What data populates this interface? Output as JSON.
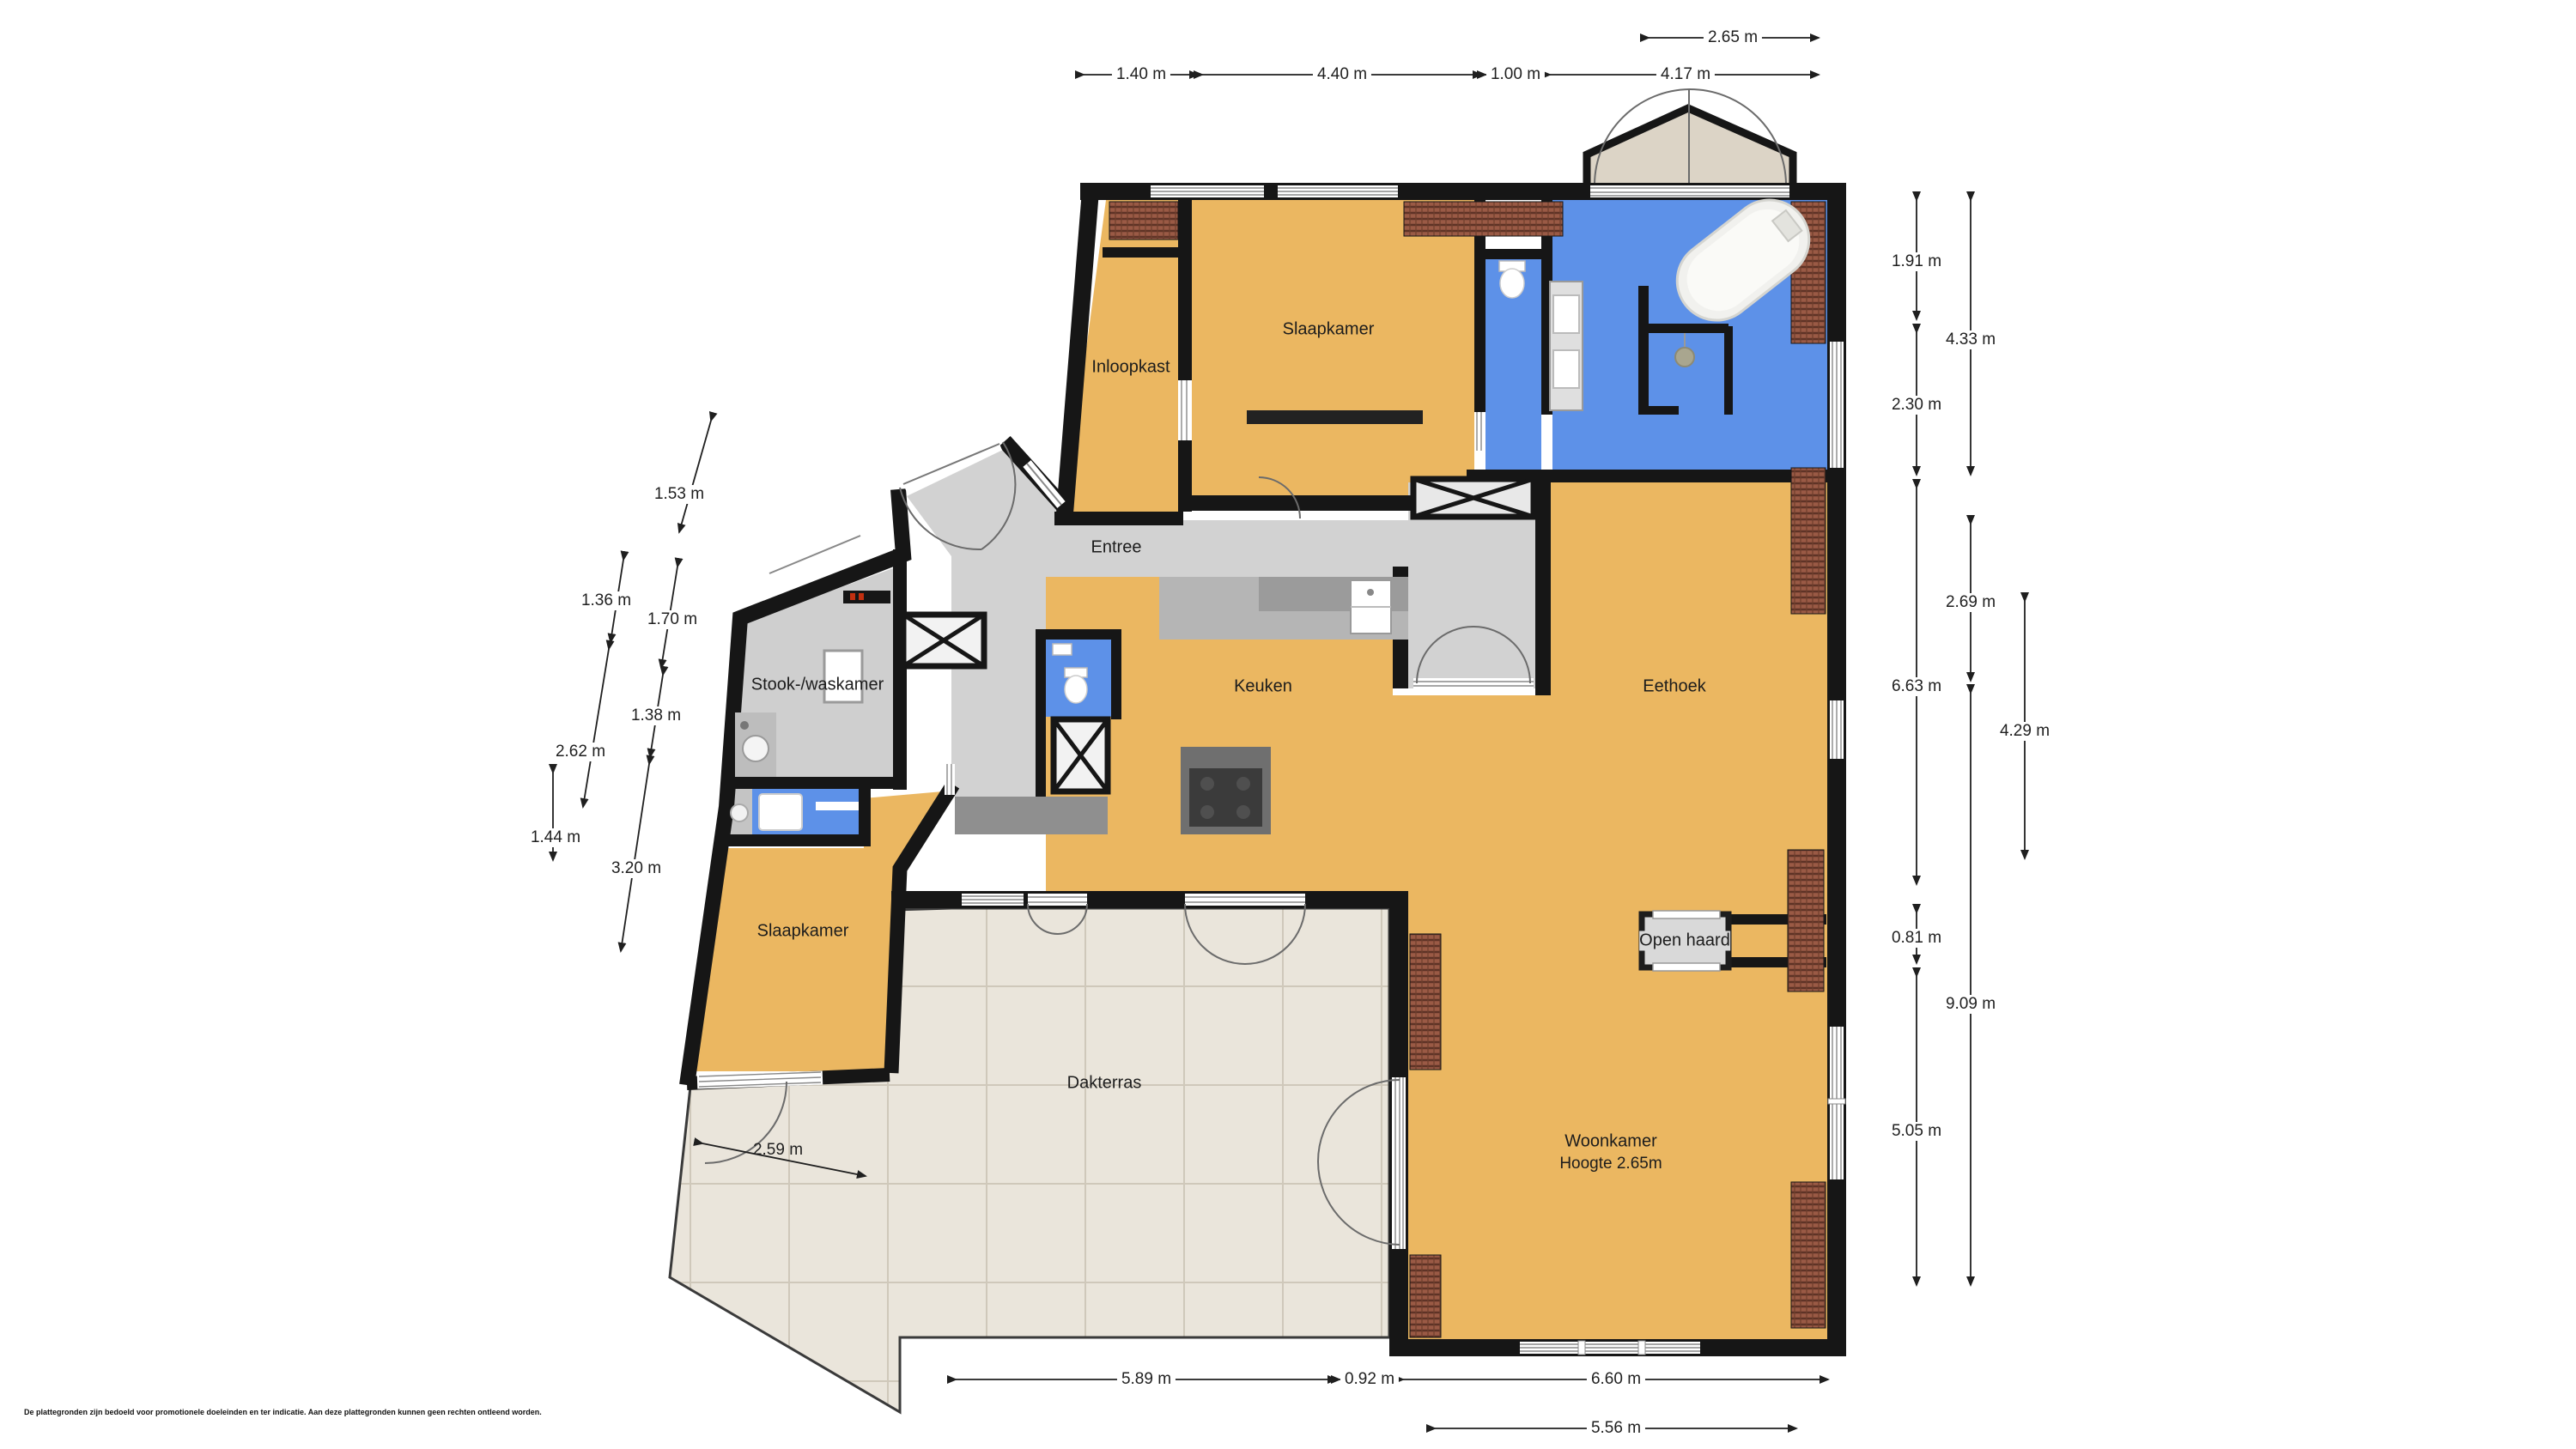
{
  "title": "Floor plan (plattegrond)",
  "colors": {
    "floor_orange": "#EBB761",
    "floor_blue": "#5D91E8",
    "floor_gray": "#D2D2D2",
    "floor_terrace": "#EAE5DB",
    "wall_black": "#161616",
    "roof_tiles": "#9A5A45",
    "bay_beige": "#DCD4C6",
    "counter_gray": "#9B9B9B"
  },
  "rooms": {
    "inloopkast": {
      "label": "Inloopkast"
    },
    "slaapkamer_top": {
      "label": "Slaapkamer"
    },
    "entree": {
      "label": "Entree"
    },
    "stook_waskamer": {
      "label": "Stook-/waskamer"
    },
    "keuken": {
      "label": "Keuken"
    },
    "eethoek": {
      "label": "Eethoek"
    },
    "slaapkamer_bottom": {
      "label": "Slaapkamer"
    },
    "woonkamer": {
      "label": "Woonkamer",
      "subtitle": "Hoogte 2.65m"
    },
    "dakterras": {
      "label": "Dakterras"
    },
    "open_haard": {
      "label": "Open haard"
    }
  },
  "dims": {
    "top": [
      {
        "label": "2.65 m"
      },
      {
        "label": "1.40 m"
      },
      {
        "label": "4.40 m"
      },
      {
        "label": "1.00 m"
      },
      {
        "label": "4.17 m"
      }
    ],
    "right": [
      {
        "label": "1.91 m"
      },
      {
        "label": "4.33 m"
      },
      {
        "label": "2.30 m"
      },
      {
        "label": "2.69 m"
      },
      {
        "label": "6.63 m"
      },
      {
        "label": "4.29 m"
      },
      {
        "label": "0.81 m"
      },
      {
        "label": "9.09 m"
      },
      {
        "label": "5.05 m"
      }
    ],
    "left": [
      {
        "label": "1.53 m"
      },
      {
        "label": "1.36 m"
      },
      {
        "label": "1.70 m"
      },
      {
        "label": "2.62 m"
      },
      {
        "label": "1.38 m"
      },
      {
        "label": "1.44 m"
      },
      {
        "label": "3.20 m"
      }
    ],
    "bottom": [
      {
        "label": "5.89 m"
      },
      {
        "label": "0.92 m"
      },
      {
        "label": "6.60 m"
      },
      {
        "label": "5.56 m"
      }
    ],
    "terrace_inner": {
      "label": "2.59 m"
    }
  },
  "icons": {
    "bathtub-icon": "svg-shape",
    "toilet-icon": "svg-shape",
    "washbasin-icon": "svg-shape",
    "shower-head-icon": "svg-shape",
    "washing-machine-icon": "svg-shape",
    "kitchen-sink-icon": "svg-shape",
    "cooktop-icon": "svg-shape",
    "boiler-icon": "svg-shape",
    "door-swing-icon": "svg-arc",
    "void-cross-icon": "svg-x"
  },
  "disclaimer": "De plattegronden zijn bedoeld voor promotionele doeleinden en ter indicatie. Aan deze plattegronden kunnen geen rechten ontleend worden."
}
